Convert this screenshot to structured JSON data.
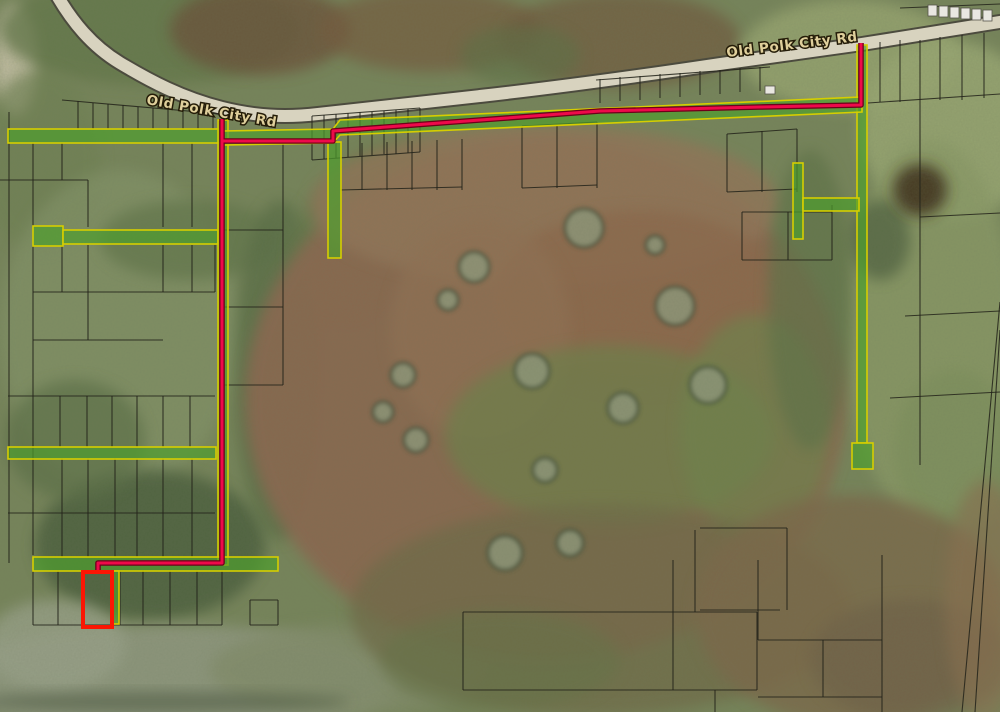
{
  "map": {
    "labels": [
      {
        "text": "Old Polk City Rd"
      },
      {
        "text": "Old Polk City Rd"
      }
    ],
    "palette": {
      "base_ground": "#76845a",
      "parcel_line": "#23231a",
      "highlight_fill": "#4f9e2d",
      "highlight_outline": "#d6ce00",
      "route_core": "#ee0a4a",
      "route_casing": "#6e0019",
      "selected_parcel": "#fb1604",
      "road_surface": "#d8d3bf",
      "road_casing": "#4c4b3e",
      "island_fill": "#8e9779",
      "island_ring": "#3a4833",
      "structure_fill": "#e9e7e1",
      "label_fill": "#dfcf9b",
      "label_halo": "#241c08"
    },
    "road": {
      "path": "M 55 -8 C 72 22 92 46 120 63 C 150 81 182 98 222 108 C 254 116 284 118 318 114 C 380 107 430 102 480 96 C 560 87 640 76 720 64 C 770 57 820 50 862 44 L 1012 20"
    },
    "route_polylines": [
      "222,119 222,563 98,563 98,571",
      "222,141 333,141 333,131 480,120 600,111 760,107 861,105 861,43"
    ],
    "selected_parcel": {
      "x": 83,
      "y": 572,
      "w": 29,
      "h": 55
    },
    "highlight_rects": [
      {
        "x": 8,
        "y": 129,
        "w": 214,
        "h": 14
      },
      {
        "x": 33,
        "y": 226,
        "w": 30,
        "h": 20
      },
      {
        "x": 63,
        "y": 230,
        "w": 155,
        "h": 14
      },
      {
        "x": 328,
        "y": 142,
        "w": 13,
        "h": 116
      },
      {
        "x": 218,
        "y": 120,
        "w": 10,
        "h": 445
      },
      {
        "x": 33,
        "y": 557,
        "w": 245,
        "h": 14
      },
      {
        "x": 8,
        "y": 447,
        "w": 208,
        "h": 12
      },
      {
        "x": 857,
        "y": 45,
        "w": 10,
        "h": 398
      },
      {
        "x": 852,
        "y": 443,
        "w": 21,
        "h": 26
      },
      {
        "x": 793,
        "y": 163,
        "w": 10,
        "h": 76
      },
      {
        "x": 803,
        "y": 198,
        "w": 56,
        "h": 13
      },
      {
        "x": 111,
        "y": 571,
        "w": 8,
        "h": 53
      }
    ],
    "highlight_polygons": [
      "222,131 333,129 340,120 862,97 862,112 340,135 333,143 222,145"
    ],
    "terrain": [
      {
        "x": 15,
        "y": 60,
        "rx": 22,
        "ry": 55,
        "f": "#cbc5ab",
        "o": 0.85
      },
      {
        "x": 150,
        "y": 30,
        "rx": 150,
        "ry": 55,
        "f": "#647749",
        "o": 0.8
      },
      {
        "x": 40,
        "y": 160,
        "rx": 60,
        "ry": 90,
        "f": "#6f8152",
        "o": 0.7
      },
      {
        "x": 260,
        "y": 30,
        "rx": 90,
        "ry": 45,
        "f": "#6b5038",
        "o": 0.75
      },
      {
        "x": 430,
        "y": 30,
        "rx": 110,
        "ry": 42,
        "f": "#755a3e",
        "o": 0.7
      },
      {
        "x": 620,
        "y": 40,
        "rx": 120,
        "ry": 48,
        "f": "#6f543a",
        "o": 0.65
      },
      {
        "x": 520,
        "y": 55,
        "rx": 60,
        "ry": 30,
        "f": "#5d6f44",
        "o": 0.6
      },
      {
        "x": 850,
        "y": 55,
        "rx": 110,
        "ry": 55,
        "f": "#95a36e",
        "o": 0.9
      },
      {
        "x": 950,
        "y": 130,
        "rx": 90,
        "ry": 90,
        "f": "#9aa873",
        "o": 0.85
      },
      {
        "x": 930,
        "y": 330,
        "rx": 85,
        "ry": 190,
        "f": "#8a9a66",
        "o": 0.8
      },
      {
        "x": 880,
        "y": 240,
        "rx": 30,
        "ry": 40,
        "f": "#4c5d3d",
        "o": 0.7
      },
      {
        "x": 955,
        "y": 450,
        "rx": 60,
        "ry": 80,
        "f": "#7d8f5c",
        "o": 0.7
      },
      {
        "x": 920,
        "y": 190,
        "rx": 27,
        "ry": 26,
        "f": "#40301f",
        "o": 0.9
      },
      {
        "x": 120,
        "y": 330,
        "rx": 120,
        "ry": 160,
        "f": "#85956a",
        "o": 0.6
      },
      {
        "x": 150,
        "y": 545,
        "rx": 115,
        "ry": 75,
        "f": "#4c5f3e",
        "o": 0.85
      },
      {
        "x": 75,
        "y": 440,
        "rx": 70,
        "ry": 60,
        "f": "#5c7047",
        "o": 0.7
      },
      {
        "x": 190,
        "y": 240,
        "rx": 90,
        "ry": 40,
        "f": "#60744a",
        "o": 0.7
      },
      {
        "x": 280,
        "y": 370,
        "rx": 45,
        "ry": 170,
        "f": "#596d45",
        "o": 0.75
      },
      {
        "x": 400,
        "y": 200,
        "rx": 70,
        "ry": 60,
        "f": "#697c4d",
        "o": 0.8
      },
      {
        "x": 350,
        "y": 260,
        "rx": 60,
        "ry": 80,
        "f": "#63764a",
        "o": 0.7
      },
      {
        "x": 170,
        "y": 680,
        "rx": 230,
        "ry": 55,
        "f": "#8f977f",
        "o": 0.9
      },
      {
        "x": 55,
        "y": 645,
        "rx": 70,
        "ry": 45,
        "f": "#99a189",
        "o": 0.8
      },
      {
        "x": 350,
        "y": 670,
        "rx": 140,
        "ry": 45,
        "f": "#828c6a",
        "o": 0.8
      },
      {
        "x": 160,
        "y": 702,
        "rx": 190,
        "ry": 10,
        "f": "#47523c",
        "o": 0.55
      },
      {
        "x": 545,
        "y": 400,
        "rx": 300,
        "ry": 262,
        "f": "#8a6750",
        "o": 0.95
      },
      {
        "x": 545,
        "y": 205,
        "rx": 235,
        "ry": 80,
        "f": "#927458",
        "o": 0.85
      },
      {
        "x": 640,
        "y": 300,
        "rx": 150,
        "ry": 90,
        "f": "#8d684c",
        "o": 0.8
      },
      {
        "x": 480,
        "y": 330,
        "rx": 90,
        "ry": 110,
        "f": "#916f52",
        "o": 0.7
      },
      {
        "x": 610,
        "y": 435,
        "rx": 165,
        "ry": 90,
        "f": "#6d8049",
        "o": 0.7
      },
      {
        "x": 755,
        "y": 430,
        "rx": 75,
        "ry": 115,
        "f": "#70824c",
        "o": 0.7
      },
      {
        "x": 810,
        "y": 300,
        "rx": 42,
        "ry": 150,
        "f": "#5e7246",
        "o": 0.7
      },
      {
        "x": 600,
        "y": 610,
        "rx": 250,
        "ry": 105,
        "f": "#6f6a46",
        "o": 0.75
      },
      {
        "x": 850,
        "y": 610,
        "rx": 155,
        "ry": 115,
        "f": "#7b684a",
        "o": 0.8
      },
      {
        "x": 910,
        "y": 660,
        "rx": 100,
        "ry": 60,
        "f": "#6f6146",
        "o": 0.7
      },
      {
        "x": 500,
        "y": 660,
        "rx": 120,
        "ry": 50,
        "f": "#667247",
        "o": 0.6
      },
      {
        "x": 985,
        "y": 600,
        "rx": 40,
        "ry": 120,
        "f": "#8b6f50",
        "o": 0.6
      }
    ],
    "tree_islands": [
      {
        "cx": 584,
        "cy": 228,
        "r": 19
      },
      {
        "cx": 474,
        "cy": 267,
        "r": 15
      },
      {
        "cx": 675,
        "cy": 306,
        "r": 19
      },
      {
        "cx": 532,
        "cy": 371,
        "r": 17
      },
      {
        "cx": 708,
        "cy": 385,
        "r": 18
      },
      {
        "cx": 403,
        "cy": 375,
        "r": 12
      },
      {
        "cx": 383,
        "cy": 412,
        "r": 10
      },
      {
        "cx": 416,
        "cy": 440,
        "r": 12
      },
      {
        "cx": 623,
        "cy": 408,
        "r": 15
      },
      {
        "cx": 655,
        "cy": 245,
        "r": 9
      },
      {
        "cx": 545,
        "cy": 470,
        "r": 12
      },
      {
        "cx": 505,
        "cy": 553,
        "r": 17
      },
      {
        "cx": 570,
        "cy": 543,
        "r": 13
      },
      {
        "cx": 448,
        "cy": 300,
        "r": 10
      }
    ],
    "structures": [
      {
        "x": 928,
        "y": 5,
        "w": 9,
        "h": 11
      },
      {
        "x": 939,
        "y": 6,
        "w": 9,
        "h": 11
      },
      {
        "x": 950,
        "y": 7,
        "w": 9,
        "h": 11
      },
      {
        "x": 961,
        "y": 8,
        "w": 9,
        "h": 11
      },
      {
        "x": 972,
        "y": 9,
        "w": 9,
        "h": 11
      },
      {
        "x": 983,
        "y": 10,
        "w": 9,
        "h": 11
      },
      {
        "x": 765,
        "y": 86,
        "w": 10,
        "h": 8
      }
    ],
    "parcel_lines": [
      [
        9,
        112,
        9,
        563
      ],
      [
        62,
        100,
        222,
        114
      ],
      [
        78,
        101,
        78,
        129
      ],
      [
        93,
        103,
        93,
        129
      ],
      [
        108,
        104,
        108,
        129
      ],
      [
        123,
        105,
        123,
        129
      ],
      [
        138,
        107,
        138,
        129
      ],
      [
        153,
        108,
        153,
        129
      ],
      [
        168,
        109,
        168,
        129
      ],
      [
        183,
        111,
        183,
        129
      ],
      [
        198,
        112,
        198,
        129
      ],
      [
        213,
        113,
        213,
        129
      ],
      [
        33,
        143,
        33,
        227
      ],
      [
        62,
        143,
        62,
        180
      ],
      [
        88,
        180,
        88,
        227
      ],
      [
        163,
        143,
        163,
        227
      ],
      [
        192,
        143,
        192,
        227
      ],
      [
        0,
        180,
        88,
        180
      ],
      [
        33,
        245,
        33,
        555
      ],
      [
        62,
        245,
        62,
        292
      ],
      [
        88,
        245,
        88,
        292
      ],
      [
        163,
        245,
        163,
        292
      ],
      [
        192,
        245,
        192,
        292
      ],
      [
        215,
        245,
        215,
        292
      ],
      [
        33,
        292,
        215,
        292
      ],
      [
        88,
        292,
        88,
        340
      ],
      [
        33,
        340,
        163,
        340
      ],
      [
        8,
        396,
        215,
        396
      ],
      [
        60,
        396,
        60,
        447
      ],
      [
        87,
        396,
        87,
        447
      ],
      [
        112,
        396,
        112,
        447
      ],
      [
        137,
        396,
        137,
        447
      ],
      [
        163,
        396,
        163,
        447
      ],
      [
        190,
        396,
        190,
        447
      ],
      [
        8,
        513,
        215,
        513
      ],
      [
        62,
        458,
        62,
        557
      ],
      [
        88,
        458,
        88,
        557
      ],
      [
        115,
        458,
        115,
        557
      ],
      [
        137,
        458,
        137,
        557
      ],
      [
        163,
        458,
        163,
        557
      ],
      [
        192,
        458,
        192,
        557
      ],
      [
        33,
        570,
        33,
        625
      ],
      [
        58,
        570,
        58,
        625
      ],
      [
        120,
        570,
        120,
        625
      ],
      [
        143,
        570,
        143,
        625
      ],
      [
        170,
        570,
        170,
        625
      ],
      [
        197,
        570,
        197,
        625
      ],
      [
        222,
        570,
        222,
        625
      ],
      [
        33,
        625,
        222,
        625
      ],
      [
        250,
        600,
        250,
        625
      ],
      [
        278,
        600,
        278,
        625
      ],
      [
        250,
        600,
        278,
        600
      ],
      [
        250,
        625,
        278,
        625
      ],
      [
        283,
        143,
        283,
        385
      ],
      [
        224,
        230,
        283,
        230
      ],
      [
        224,
        307,
        283,
        307
      ],
      [
        224,
        385,
        283,
        385
      ],
      [
        312,
        116,
        420,
        108
      ],
      [
        312,
        116,
        312,
        160
      ],
      [
        324,
        115,
        324,
        159
      ],
      [
        336,
        114,
        336,
        158
      ],
      [
        348,
        113,
        348,
        157
      ],
      [
        360,
        112,
        360,
        156
      ],
      [
        372,
        112,
        372,
        155
      ],
      [
        384,
        111,
        384,
        154
      ],
      [
        396,
        110,
        396,
        154
      ],
      [
        408,
        109,
        408,
        153
      ],
      [
        420,
        108,
        420,
        152
      ],
      [
        312,
        160,
        420,
        152
      ],
      [
        362,
        143,
        362,
        190
      ],
      [
        387,
        142,
        387,
        190
      ],
      [
        412,
        141,
        412,
        190
      ],
      [
        437,
        140,
        437,
        190
      ],
      [
        462,
        139,
        462,
        190
      ],
      [
        340,
        190,
        462,
        187
      ],
      [
        522,
        126,
        522,
        188
      ],
      [
        557,
        124,
        557,
        188
      ],
      [
        597,
        122,
        597,
        188
      ],
      [
        522,
        126,
        597,
        122
      ],
      [
        522,
        188,
        597,
        185
      ],
      [
        596,
        80,
        770,
        67
      ],
      [
        600,
        79,
        600,
        103
      ],
      [
        620,
        77,
        620,
        101
      ],
      [
        640,
        76,
        640,
        100
      ],
      [
        660,
        74,
        660,
        98
      ],
      [
        680,
        73,
        680,
        97
      ],
      [
        700,
        71,
        700,
        95
      ],
      [
        720,
        70,
        720,
        94
      ],
      [
        740,
        68,
        740,
        92
      ],
      [
        760,
        67,
        760,
        91
      ],
      [
        727,
        134,
        727,
        192
      ],
      [
        762,
        131,
        762,
        192
      ],
      [
        797,
        129,
        797,
        192
      ],
      [
        727,
        134,
        797,
        129
      ],
      [
        727,
        192,
        797,
        189
      ],
      [
        920,
        40,
        920,
        465
      ],
      [
        880,
        42,
        880,
        102
      ],
      [
        900,
        40,
        900,
        102
      ],
      [
        940,
        37,
        940,
        100
      ],
      [
        962,
        35,
        962,
        100
      ],
      [
        984,
        33,
        984,
        98
      ],
      [
        868,
        103,
        1000,
        94
      ],
      [
        742,
        212,
        832,
        212
      ],
      [
        742,
        260,
        832,
        260
      ],
      [
        742,
        212,
        742,
        260
      ],
      [
        788,
        212,
        788,
        260
      ],
      [
        832,
        205,
        832,
        260
      ],
      [
        920,
        217,
        1000,
        213
      ],
      [
        905,
        316,
        1000,
        311
      ],
      [
        890,
        398,
        1000,
        392
      ],
      [
        900,
        8,
        1000,
        4
      ],
      [
        695,
        530,
        695,
        612
      ],
      [
        700,
        528,
        787,
        528
      ],
      [
        787,
        528,
        787,
        610
      ],
      [
        700,
        610,
        780,
        610
      ],
      [
        463,
        612,
        757,
        612
      ],
      [
        463,
        612,
        463,
        690
      ],
      [
        463,
        690,
        757,
        690
      ],
      [
        757,
        612,
        757,
        690
      ],
      [
        673,
        560,
        673,
        690
      ],
      [
        715,
        690,
        715,
        712
      ],
      [
        758,
        560,
        758,
        640
      ],
      [
        758,
        640,
        882,
        640
      ],
      [
        882,
        555,
        882,
        712
      ],
      [
        758,
        697,
        882,
        697
      ],
      [
        823,
        640,
        823,
        697
      ],
      [
        1000,
        302,
        962,
        712
      ],
      [
        1000,
        330,
        975,
        712
      ]
    ]
  }
}
